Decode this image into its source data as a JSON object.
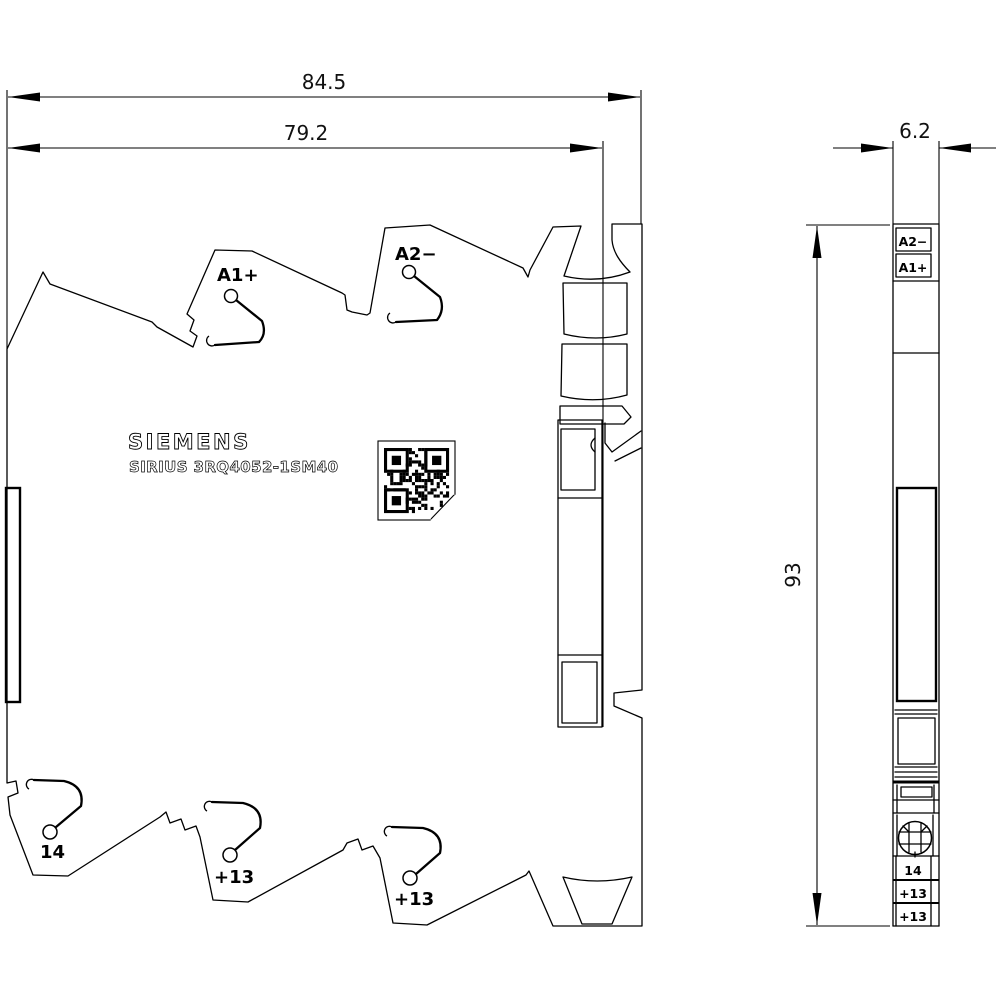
{
  "page": {
    "background": "#ffffff",
    "line_color": "#000000",
    "type_note": "technical dimensional drawing, front view and side view"
  },
  "dimensions": {
    "total_width": "84.5",
    "body_width": "79.2",
    "depth": "6.2",
    "height": "93"
  },
  "main_view": {
    "brand": "SIEMENS",
    "product": "SIRIUS 3RQ4052-1SM40",
    "terminals": {
      "a1": "A1+",
      "a2": "A2−",
      "t14": "14",
      "t13_mid": "+13",
      "t13_right": "+13"
    },
    "qr_code": "data-matrix-code"
  },
  "side_view": {
    "labels": {
      "a2": "A2−",
      "a1": "A1+",
      "t14": "14",
      "t13a": "+13",
      "t13b": "+13"
    }
  }
}
